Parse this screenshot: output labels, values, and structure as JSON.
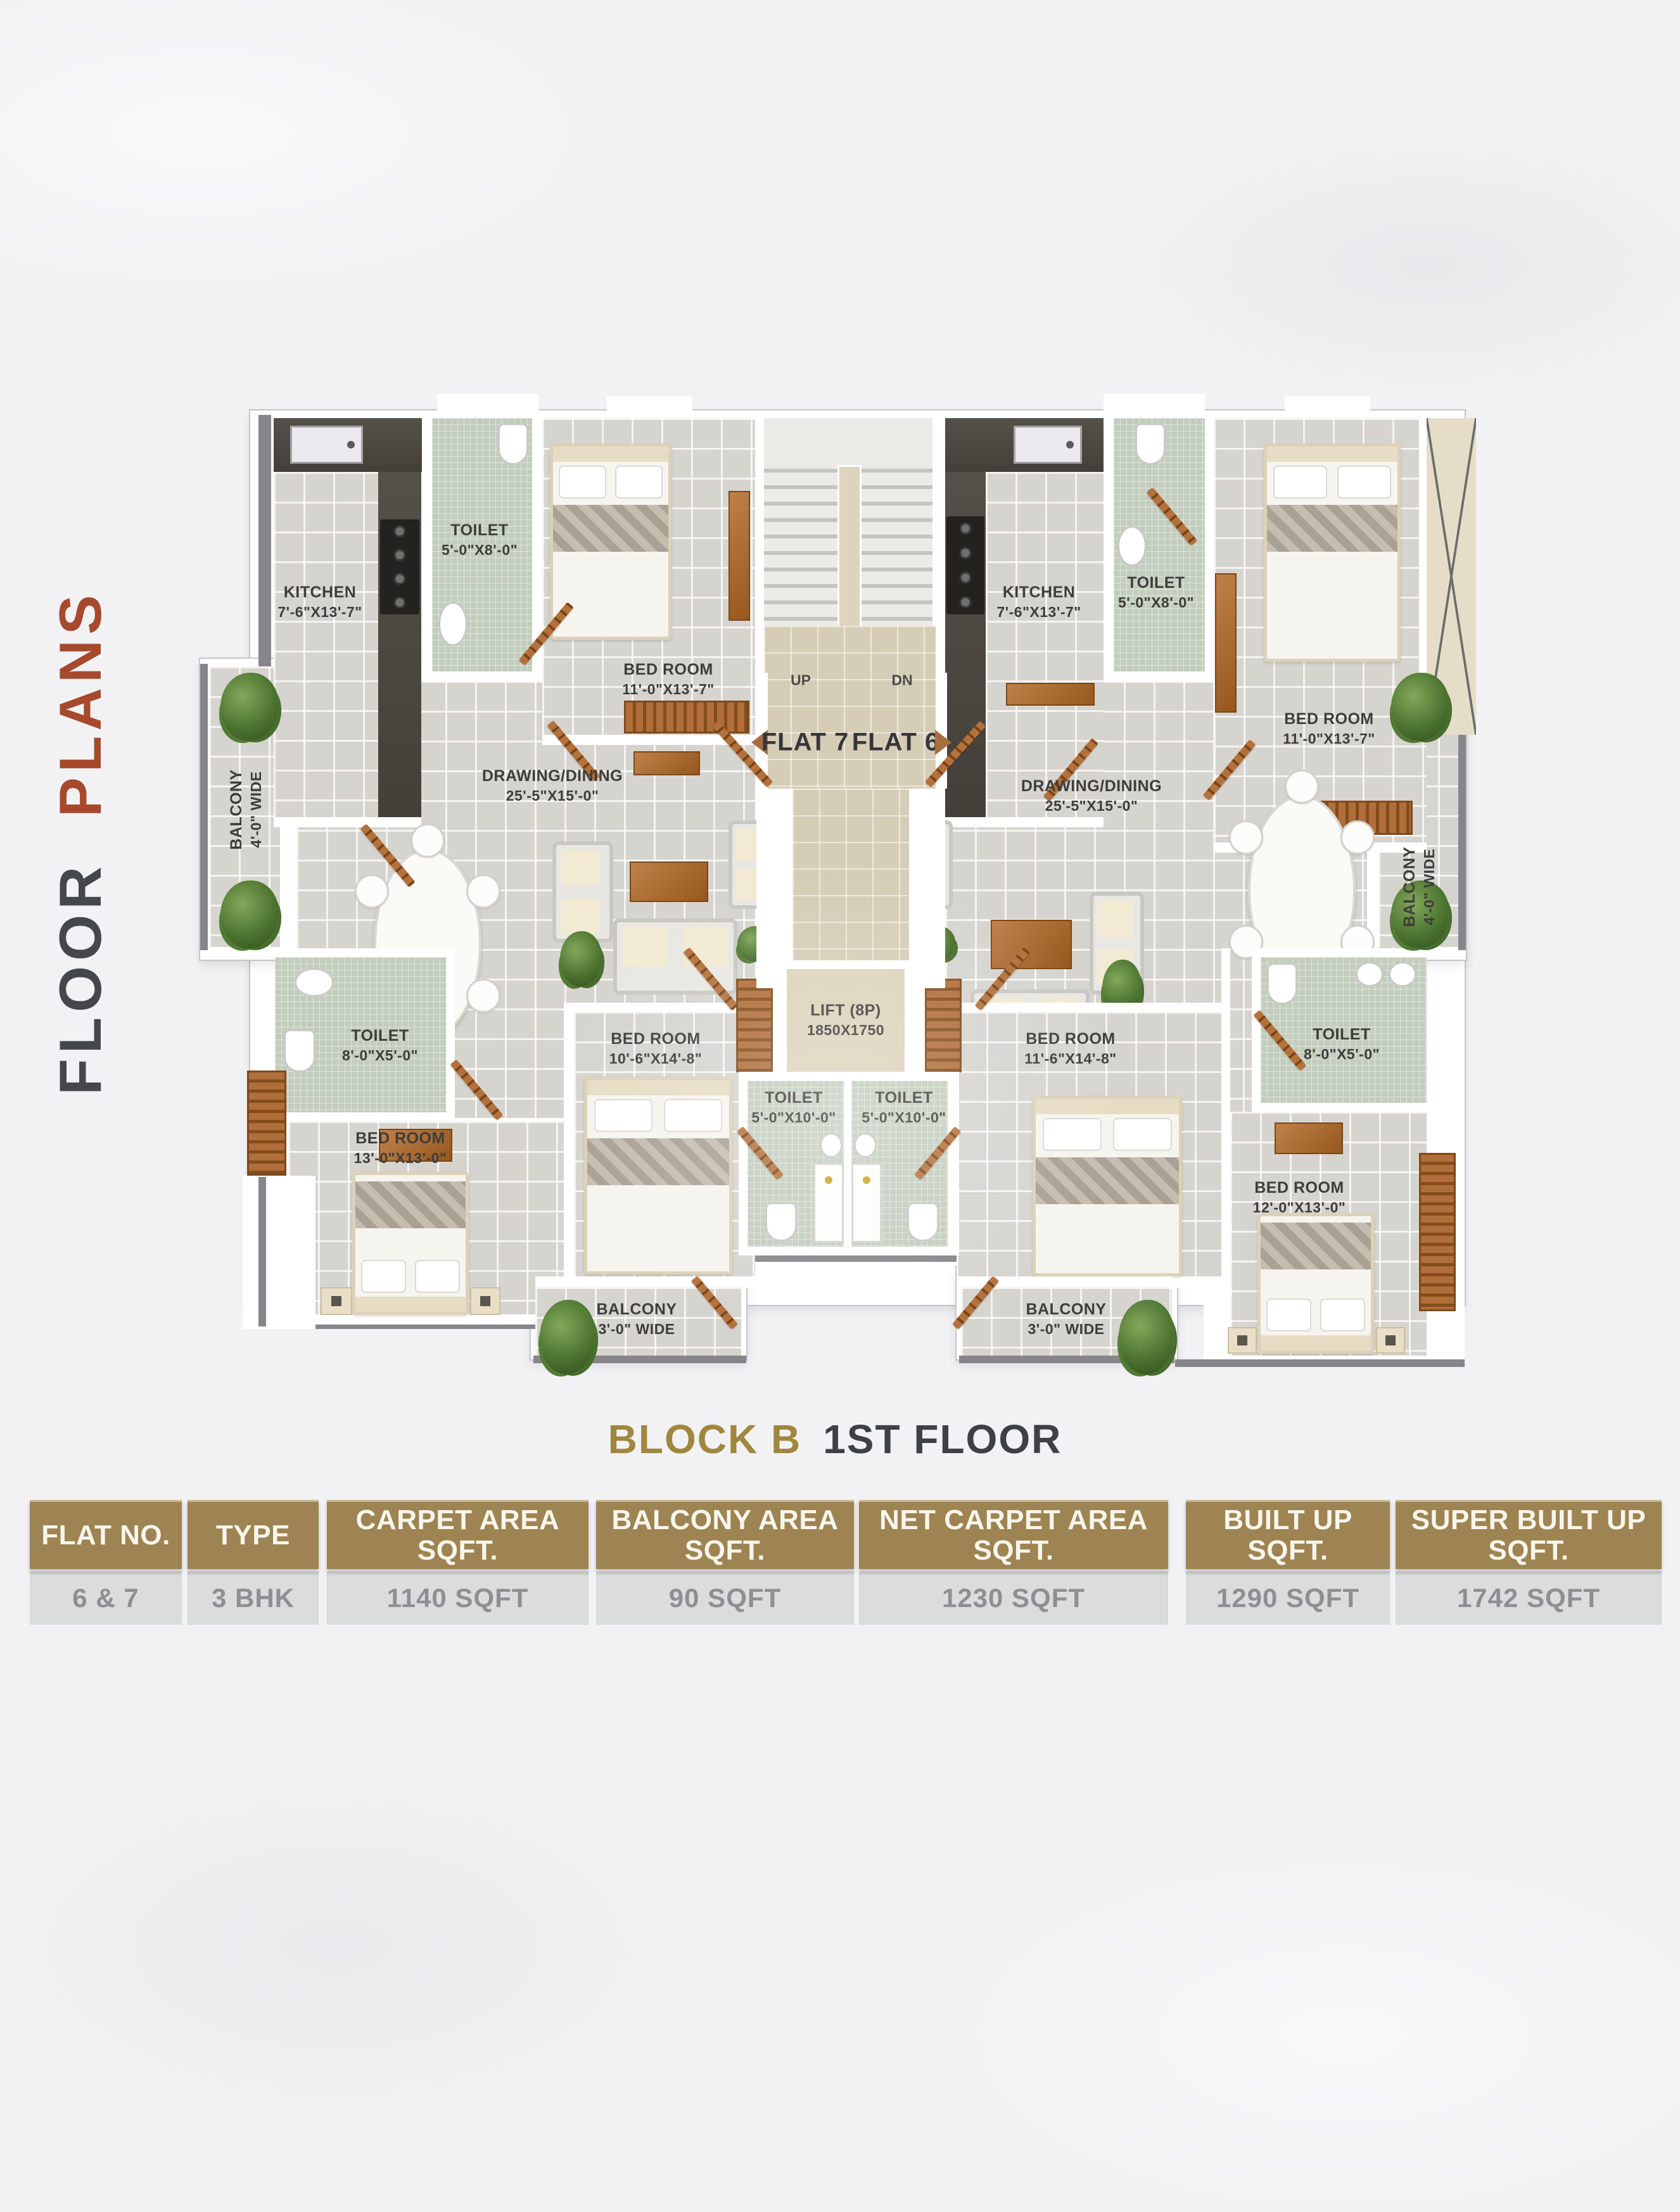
{
  "side_title": {
    "floor": "FLOOR",
    "plans": "PLANS"
  },
  "plan_title": {
    "block": "BLOCK B",
    "floor": "1ST FLOOR"
  },
  "core": {
    "up": "UP",
    "dn": "DN",
    "flat_left": "FLAT 7",
    "flat_right": "FLAT 6",
    "lift_name": "LIFT (8P)",
    "lift_dims": "1850X1750"
  },
  "rooms": {
    "left": {
      "kitchen": {
        "name": "KITCHEN",
        "dims": "7'-6\"X13'-7\""
      },
      "toilet_top": {
        "name": "TOILET",
        "dims": "5'-0\"X8'-0\""
      },
      "bedroom_top": {
        "name": "BED ROOM",
        "dims": "11'-0\"X13'-7\""
      },
      "drawing": {
        "name": "DRAWING/DINING",
        "dims": "25'-5\"X15'-0\""
      },
      "balcony_side": {
        "name": "BALCONY",
        "dims": "4'-0\" WIDE"
      },
      "toilet_mid": {
        "name": "TOILET",
        "dims": "8'-0\"X5'-0\""
      },
      "bedroom_corner": {
        "name": "BED ROOM",
        "dims": "13'-0\"X13'-0\""
      },
      "bedroom_center": {
        "name": "BED ROOM",
        "dims": "10'-6\"X14'-8\""
      },
      "toilet_bottom": {
        "name": "TOILET",
        "dims": "5'-0\"X10'-0\""
      },
      "balcony_bottom": {
        "name": "BALCONY",
        "dims": "3'-0\" WIDE"
      }
    },
    "right": {
      "kitchen": {
        "name": "KITCHEN",
        "dims": "7'-6\"X13'-7\""
      },
      "toilet_top": {
        "name": "TOILET",
        "dims": "5'-0\"X8'-0\""
      },
      "bedroom_top": {
        "name": "BED ROOM",
        "dims": "11'-0\"X13'-7\""
      },
      "drawing": {
        "name": "DRAWING/DINING",
        "dims": "25'-5\"X15'-0\""
      },
      "balcony_side": {
        "name": "BALCONY",
        "dims": "4'-0\" WIDE"
      },
      "toilet_mid": {
        "name": "TOILET",
        "dims": "8'-0\"X5'-0\""
      },
      "bedroom_corner": {
        "name": "BED ROOM",
        "dims": "12'-0\"X13'-0\""
      },
      "bedroom_center": {
        "name": "BED ROOM",
        "dims": "11'-6\"X14'-8\""
      },
      "toilet_bottom": {
        "name": "TOILET",
        "dims": "5'-0\"X10'-0\""
      },
      "balcony_bottom": {
        "name": "BALCONY",
        "dims": "3'-0\" WIDE"
      }
    }
  },
  "table": {
    "headers": [
      "FLAT NO.",
      "TYPE",
      "CARPET AREA\nSQFT.",
      "BALCONY AREA\nSQFT.",
      "NET CARPET AREA\nSQFT.",
      "BUILT UP\nSQFT.",
      "SUPER BUILT UP\nSQFT."
    ],
    "row": [
      "6 & 7",
      "3 BHK",
      "1140 SQFT",
      "90 SQFT",
      "1230 SQFT",
      "1290 SQFT",
      "1742 SQFT"
    ]
  },
  "colors": {
    "accent_rust": "#a7492c",
    "accent_gold": "#9d8452",
    "text_dark": "#46474c"
  }
}
